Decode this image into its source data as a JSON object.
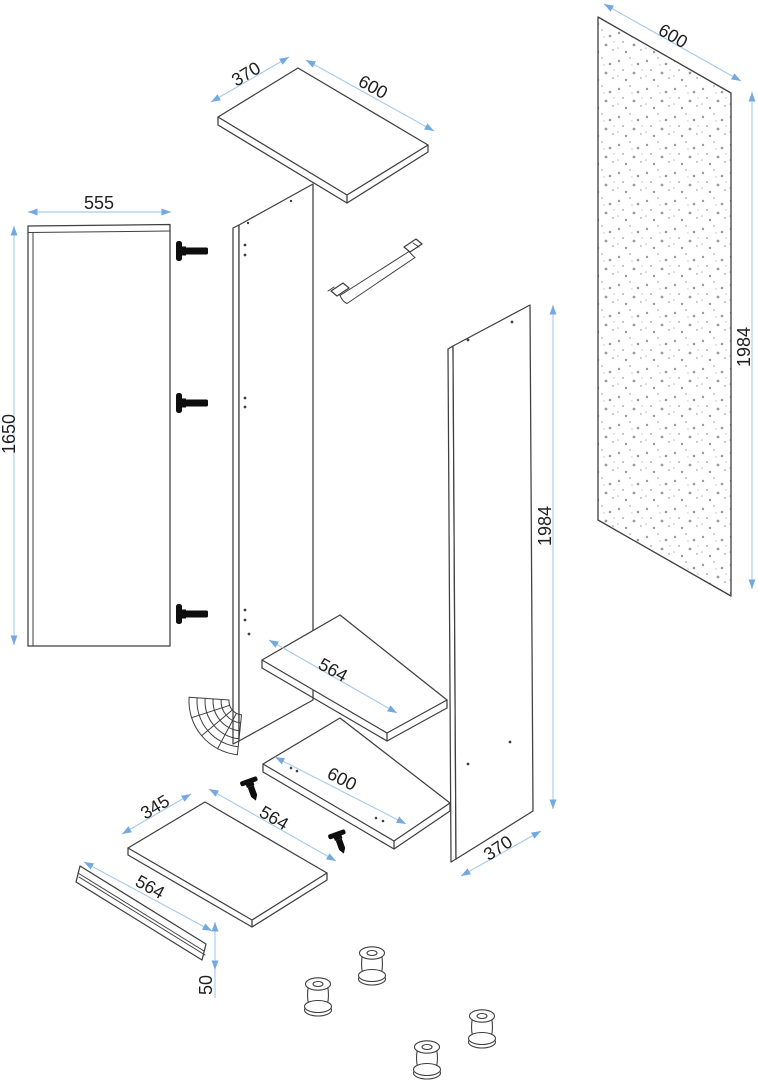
{
  "page": {
    "background": "#ffffff",
    "description": "Exploded isometric assembly diagram of a tall wardrobe cabinet with millimetre dimensions"
  },
  "colors": {
    "outline": "#3f3f3f",
    "dimension_line": "#a9cbee",
    "dimension_arrow": "#74a9e0",
    "label_text": "#1f1f1f",
    "hardware": "#0e0e0e",
    "back_panel_speckle": "#9b9b9b"
  },
  "labels": {
    "top_panel_depth": "370",
    "top_panel_width": "600",
    "door_width": "555",
    "door_height": "1650",
    "back_panel_width": "600",
    "back_panel_height": "1984",
    "side_panel_height": "1984",
    "side_panel_depth": "370",
    "upper_shelf_width": "564",
    "lower_shelf_width": "600",
    "bottom_panel_depth": "345",
    "bottom_panel_width": "564",
    "plinth_length": "564",
    "plinth_height": "50"
  }
}
